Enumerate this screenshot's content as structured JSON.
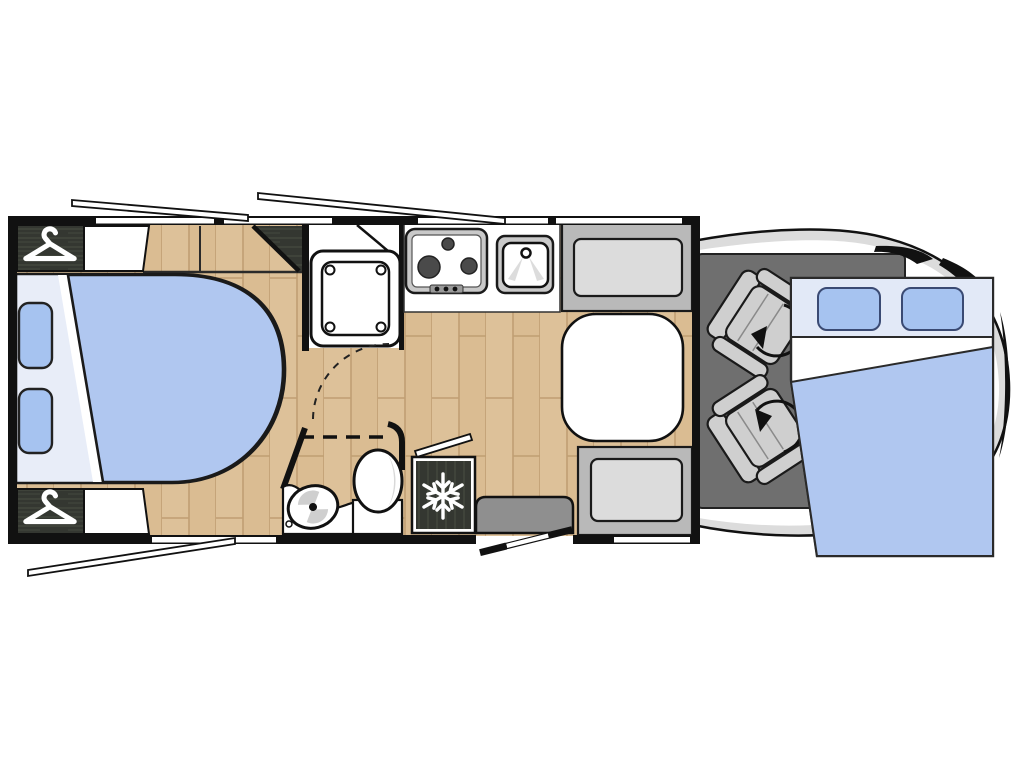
{
  "diagram": {
    "type": "motorhome-floorplan",
    "view": "top-down",
    "rooms": [
      "rear-bedroom",
      "shower",
      "washroom",
      "kitchen",
      "dinette",
      "cab"
    ],
    "furniture": [
      "rear-bed",
      "pillows",
      "wardrobe-top",
      "wardrobe-bottom",
      "bedside-panel-top",
      "bedside-panel-bottom",
      "shower-tray",
      "kitchen-counter",
      "stove-3-burner",
      "kitchen-sink",
      "fridge-freezer",
      "toilet",
      "washbasin",
      "vanity-counter",
      "dinette-bench-rear",
      "dinette-bench-front",
      "dinette-table",
      "entry-step",
      "entry-door-open",
      "swivel-cab-seat-driver",
      "swivel-cab-seat-passenger",
      "drop-down-cab-bed",
      "open-window-flaps"
    ]
  },
  "icons": {
    "hanger": "clothes-hanger-icon",
    "snowflake": "freezer-snowflake-icon",
    "swivel": "seat-rotation-arrow-icon",
    "faucet": "sink-faucet-icon"
  },
  "colors": {
    "wall": "#111111",
    "outline": "#1a1a1a",
    "wood_base": "#ddc199",
    "wood_line": "#c09e73",
    "wood_shade": "#d2b184",
    "dark_wood": "#343731",
    "dark_wood_line": "#4a4f44",
    "bed_blue": "#b0c7f0",
    "pillow_blue": "#a6c3f0",
    "sheet_light": "#e8edf8",
    "header_light": "#e2e9f7",
    "cab_floor": "#6f6f6f",
    "cab_body": "#dcdcdc",
    "seat_gray": "#cfcfcf",
    "bench_back": "#b9b9b9",
    "bench_cushion": "#dcdcdc",
    "step_gray": "#8f8f8f",
    "appliance_gray": "#c9c9c9",
    "burner_dark": "#4a4a4a",
    "white": "#ffffff"
  }
}
